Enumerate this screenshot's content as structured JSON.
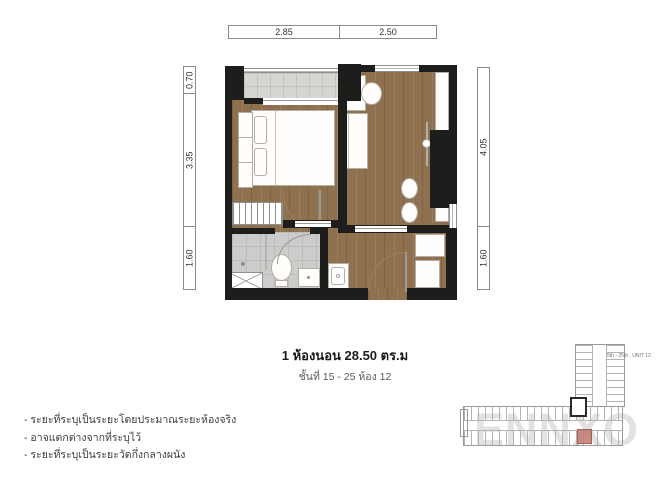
{
  "dimensions": {
    "top": [
      "2.85",
      "2.50"
    ],
    "left": [
      "0.70",
      "3.35",
      "1.60"
    ],
    "right": [
      "4.05",
      "1.60"
    ]
  },
  "caption": {
    "title": "1 ห้องนอน 28.50 ตร.ม",
    "subtitle": "ชั้นที่ 15 - 25 ห้อง 12"
  },
  "notes": [
    "- ระยะที่ระบุเป็นระยะโดยประมาณระยะห้องจริง",
    "- อาจแตกต่างจากที่ระบุไว้",
    "- ระยะที่ระบุเป็นระยะวัดกึ่งกลางผนัง"
  ],
  "keyplan": {
    "label": "5th - 25th , UNIT 12"
  },
  "watermark": "ENNXO",
  "colors": {
    "wall": "#1d1d1b",
    "wood_floor": "#8f7150",
    "balcony_tile": "#d6d6d3",
    "bathroom_tile": "#cccccb",
    "highlight_unit": "#c57f76",
    "watermark_gray": "#e2e2e2"
  }
}
